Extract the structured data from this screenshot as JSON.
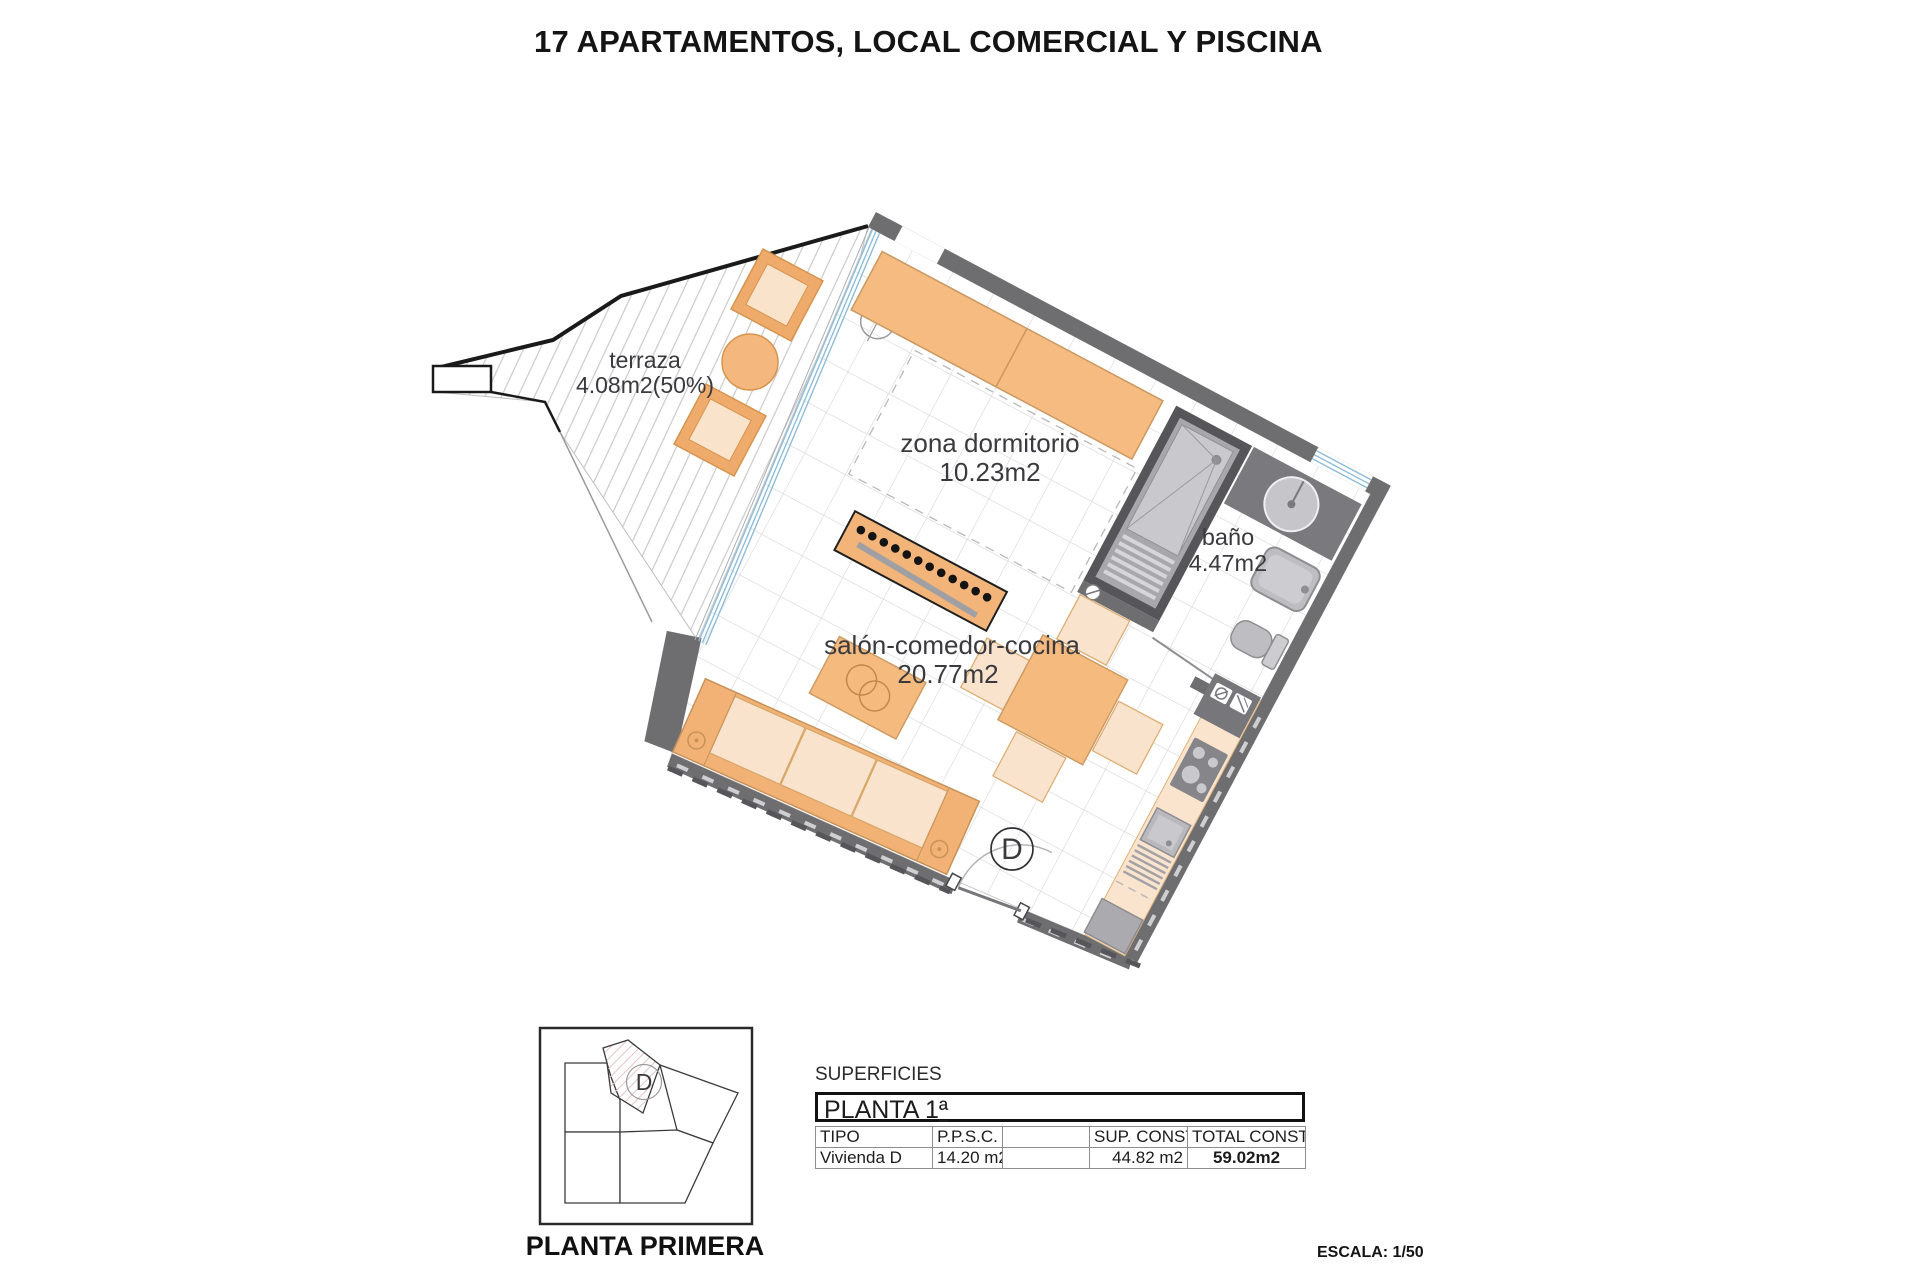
{
  "title": "17 APARTAMENTOS, LOCAL COMERCIAL Y PISCINA",
  "plan": {
    "rooms": {
      "terraza": {
        "name": "terraza",
        "area": "4.08m2(50%)"
      },
      "dormitorio": {
        "name": "zona dormitorio",
        "area": "10.23m2"
      },
      "bano": {
        "name": "baño",
        "area": "4.47m2"
      },
      "salon": {
        "name": "salón-comedor-cocina",
        "area": "20.77m2"
      }
    },
    "door_label": "D"
  },
  "key_plan": {
    "unit_label": "D",
    "caption": "PLANTA PRIMERA"
  },
  "surfaces": {
    "section_label": "SUPERFICIES",
    "floor_label_main": "PLANTA 1",
    "floor_label_ordinal": "ª",
    "columns": [
      "TIPO",
      "P.P.S.C.",
      "",
      "SUP. CONST.",
      "TOTAL CONST."
    ],
    "row": [
      "Vivienda D",
      "14.20 m2",
      "",
      "44.82 m2",
      "59.02m2"
    ]
  },
  "scale_label": "ESCALA: 1/50",
  "colors": {
    "wall": "#6E6E71",
    "furniture_orange": "#F5BB80",
    "furniture_light": "#FAE3CD",
    "glazing_blue": "#8FBDD8",
    "fixture_gray": "#BEBEC2",
    "counter_peach": "#FBE4CD"
  }
}
